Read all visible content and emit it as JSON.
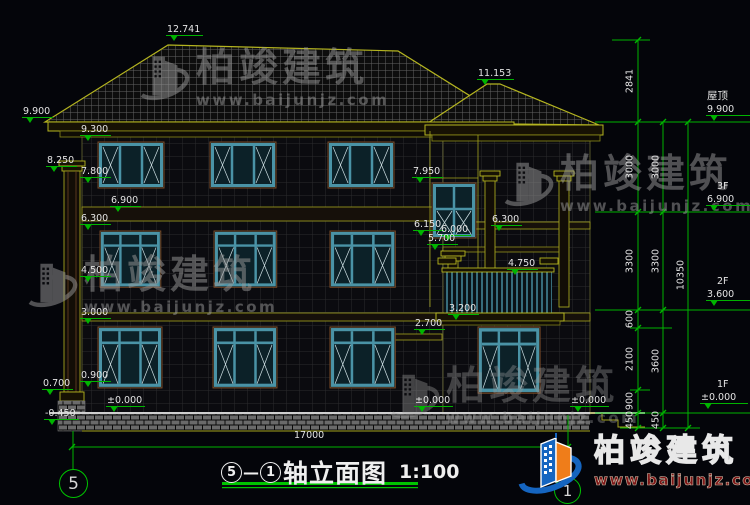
{
  "drawing": {
    "title": {
      "axis_start": "5",
      "dash": "—",
      "axis_end": "1",
      "name": "轴立面图",
      "scale": "1:100"
    },
    "axis_bubbles": {
      "left": "5",
      "right": "1"
    }
  },
  "logo": {
    "brand": "柏竣建筑",
    "url": "www.baijunjz.com"
  },
  "colors": {
    "background": "#04050a",
    "dimension_green": "#00b400",
    "text_white": "#e4e4e4",
    "line_olive": "#b5b520",
    "window_teal": "#4a93a6",
    "logo_blue": "#1565c0",
    "logo_orange": "#ef7d1a",
    "watermark_gray": "#9b9b9b",
    "url_red": "#7e1616"
  },
  "watermarks": [
    {
      "x": 136,
      "y": 48,
      "op": 0.5,
      "brand": "柏竣建筑",
      "url": "www.baijunjz.com"
    },
    {
      "x": 24,
      "y": 255,
      "op": 0.5,
      "brand": "柏竣建筑",
      "url": "www.baijunjz.com"
    },
    {
      "x": 500,
      "y": 154,
      "op": 0.5,
      "brand": "柏竣建筑",
      "url": "www.baijunjz.com"
    },
    {
      "x": 386,
      "y": 366,
      "op": 0.38,
      "brand": "柏竣建筑",
      "url": "www.baijunjz.com"
    }
  ],
  "annotations": [
    {
      "t": "12.741",
      "x": 166,
      "y": 24,
      "c": "lvl"
    },
    {
      "t": "11.153",
      "x": 477,
      "y": 68,
      "c": "lvl"
    },
    {
      "t": "9.900",
      "x": 22,
      "y": 106,
      "c": "lvl"
    },
    {
      "t": "9.300",
      "x": 80,
      "y": 124,
      "c": "lvl"
    },
    {
      "t": "8.250",
      "x": 46,
      "y": 155,
      "c": "lvl"
    },
    {
      "t": "7.800",
      "x": 80,
      "y": 166,
      "c": "lvl"
    },
    {
      "t": "6.900",
      "x": 110,
      "y": 195,
      "c": "lvl"
    },
    {
      "t": "6.300",
      "x": 80,
      "y": 213,
      "c": "lvl"
    },
    {
      "t": "4.500",
      "x": 80,
      "y": 265,
      "c": "lvl"
    },
    {
      "t": "3.000",
      "x": 80,
      "y": 307,
      "c": "lvl"
    },
    {
      "t": "0.900",
      "x": 80,
      "y": 370,
      "c": "lvl"
    },
    {
      "t": "0.700",
      "x": 42,
      "y": 378,
      "c": "lvl"
    },
    {
      "t": "±0.000",
      "x": 106,
      "y": 395,
      "c": "lvl"
    },
    {
      "t": "-0.450",
      "x": 44,
      "y": 408,
      "c": "lvl"
    },
    {
      "t": "7.950",
      "x": 412,
      "y": 166,
      "c": "lvl"
    },
    {
      "t": "6.150",
      "x": 413,
      "y": 219,
      "c": "lvl"
    },
    {
      "t": "6.000",
      "x": 440,
      "y": 224,
      "c": "lvl"
    },
    {
      "t": "5.700",
      "x": 427,
      "y": 233,
      "c": "lvl"
    },
    {
      "t": "6.300",
      "x": 491,
      "y": 214,
      "c": "lvl"
    },
    {
      "t": "4.750",
      "x": 507,
      "y": 258,
      "c": "lvl"
    },
    {
      "t": "3.200",
      "x": 448,
      "y": 303,
      "c": "lvl"
    },
    {
      "t": "2.700",
      "x": 414,
      "y": 318,
      "c": "lvl"
    },
    {
      "t": "±0.000",
      "x": 414,
      "y": 395,
      "c": "lvl"
    },
    {
      "t": "±0.000",
      "x": 570,
      "y": 395,
      "c": "lvl"
    },
    {
      "t": "屋顶",
      "x": 707,
      "y": 91,
      "c": "t cn"
    },
    {
      "t": "9.900",
      "x": 706,
      "y": 104,
      "c": "lvl w"
    },
    {
      "t": "3F",
      "x": 717,
      "y": 181,
      "c": "t"
    },
    {
      "t": "6.900",
      "x": 706,
      "y": 194,
      "c": "lvl w"
    },
    {
      "t": "2F",
      "x": 717,
      "y": 276,
      "c": "t"
    },
    {
      "t": "3.600",
      "x": 706,
      "y": 289,
      "c": "lvl w"
    },
    {
      "t": "1F",
      "x": 717,
      "y": 379,
      "c": "t"
    },
    {
      "t": "±0.000",
      "x": 700,
      "y": 392,
      "c": "lvl w"
    },
    {
      "t": "17000",
      "x": 294,
      "y": 430,
      "c": "t"
    },
    {
      "t": "2841",
      "x": 630,
      "y": 81,
      "c": "dim"
    },
    {
      "t": "3000",
      "x": 630,
      "y": 167,
      "c": "dim"
    },
    {
      "t": "3000",
      "x": 656,
      "y": 167,
      "c": "dim"
    },
    {
      "t": "3300",
      "x": 630,
      "y": 261,
      "c": "dim"
    },
    {
      "t": "3300",
      "x": 656,
      "y": 261,
      "c": "dim"
    },
    {
      "t": "600",
      "x": 630,
      "y": 319,
      "c": "dim"
    },
    {
      "t": "2100",
      "x": 630,
      "y": 359,
      "c": "dim"
    },
    {
      "t": "900",
      "x": 630,
      "y": 401,
      "c": "dim"
    },
    {
      "t": "450",
      "x": 630,
      "y": 420,
      "c": "dim"
    },
    {
      "t": "3600",
      "x": 656,
      "y": 361,
      "c": "dim"
    },
    {
      "t": "450",
      "x": 656,
      "y": 420,
      "c": "dim"
    },
    {
      "t": "10350",
      "x": 681,
      "y": 275,
      "c": "dim"
    }
  ]
}
